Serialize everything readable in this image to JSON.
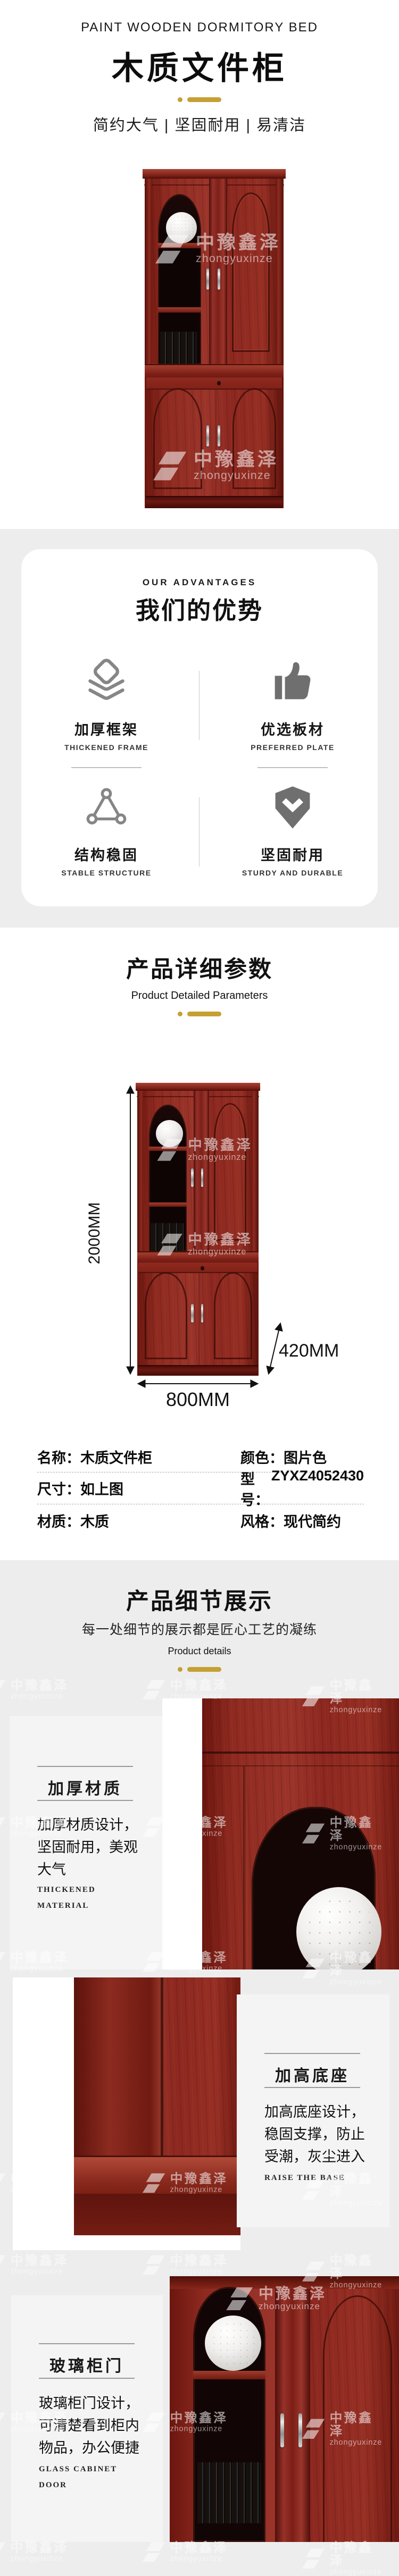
{
  "brand": {
    "cn": "中豫鑫泽",
    "en": "zhongyuxinze"
  },
  "colors": {
    "gold": "#C5A033",
    "section_bg": "#EDEDED",
    "icon_gray": "#6F6F6F",
    "wood_red": "#8C2820"
  },
  "header": {
    "eyebrow": "PAINT WOODEN DORMITORY BED",
    "title": "木质文件柜",
    "tagline": "简约大气 | 坚固耐用 | 易清洁"
  },
  "advantages": {
    "eyebrow": "OUR ADVANTAGES",
    "title": "我们的优势",
    "items": [
      {
        "icon": "layers-icon",
        "title": "加厚框架",
        "subtitle": "THICKENED FRAME"
      },
      {
        "icon": "thumbs-up-icon",
        "title": "优选板材",
        "subtitle": "PREFERRED PLATE"
      },
      {
        "icon": "truss-triangle-icon",
        "title": "结构稳固",
        "subtitle": "STABLE STRUCTURE"
      },
      {
        "icon": "shield-check-icon",
        "title": "坚固耐用",
        "subtitle": "STURDY AND DURABLE"
      }
    ]
  },
  "parameters": {
    "title": "产品详细参数",
    "subtitle": "Product Detailed Parameters",
    "dim_height": "2000MM",
    "dim_depth": "420MM",
    "dim_width": "800MM",
    "specs": [
      [
        {
          "label": "名称：",
          "value": "木质文件柜"
        },
        {
          "label": "颜色：",
          "value": "图片色"
        }
      ],
      [
        {
          "label": "尺寸：",
          "value": "如上图"
        },
        {
          "label": "型号：",
          "value": "ZYXZ4052430"
        }
      ],
      [
        {
          "label": "材质：",
          "value": "木质"
        },
        {
          "label": "风格：",
          "value": "现代简约"
        }
      ]
    ]
  },
  "details": {
    "title": "产品细节展示",
    "subtitle": "每一处细节的展示都是匠心工艺的凝练",
    "subtitle_en": "Product details",
    "blocks": [
      {
        "title": "加厚材质",
        "desc": "加厚材质设计，坚固耐用，美观大气",
        "en": "THICKENED MATERIAL"
      },
      {
        "title": "加高底座",
        "desc": "加高底座设计，稳固支撑，防止受潮，灰尘进入",
        "en": "RAISE THE BASE"
      },
      {
        "title": "玻璃柜门",
        "desc": "玻璃柜门设计，可清楚看到柜内物品，办公便捷",
        "en": "GLASS CABINET DOOR"
      }
    ]
  }
}
